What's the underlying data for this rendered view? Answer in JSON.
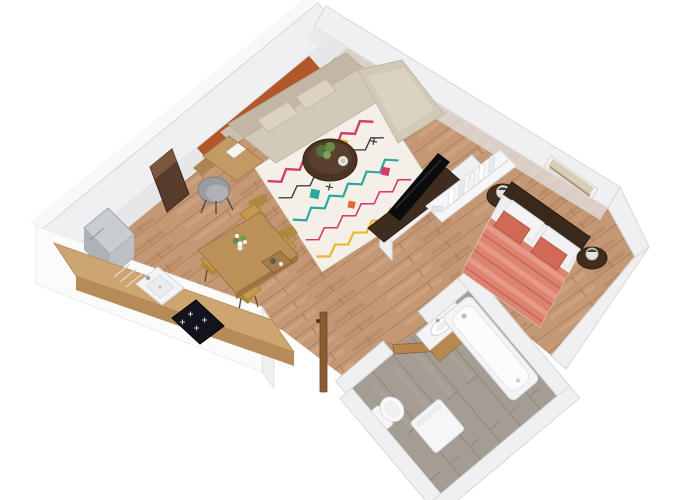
{
  "scene": {
    "kind": "3d-floorplan-cutaway-render",
    "background": "#ffffff",
    "view": "isometric top-down, rotated ~40 degrees"
  },
  "apartment": {
    "rooms": [
      {
        "name": "living-room",
        "items": [
          "sectional-sofa",
          "area-rug",
          "coffee-table",
          "desk",
          "desk-chair",
          "tall-cabinet",
          "accent-wall"
        ]
      },
      {
        "name": "dining-area",
        "items": [
          "dining-table",
          "dining-chair x4",
          "flower-vase",
          "serving-tray"
        ]
      },
      {
        "name": "kitchen",
        "items": [
          "refrigerator",
          "counter",
          "sink",
          "cooktop"
        ]
      },
      {
        "name": "bedroom",
        "items": [
          "double-bed",
          "headboard",
          "pillows",
          "nightstand x2",
          "table-lamp x2",
          "wall-art",
          "open-closet",
          "tv",
          "tv-stand",
          "partition-wall"
        ]
      },
      {
        "name": "bathroom",
        "items": [
          "bathtub",
          "vanity-sink",
          "toilet",
          "washing-machine",
          "bathroom-door"
        ]
      },
      {
        "name": "entry",
        "items": [
          "entry-door"
        ]
      }
    ]
  },
  "palette": {
    "background": "#ffffff",
    "wall_top": "#f0f0f2",
    "wall_halo": "#f8f8f9",
    "wall_face": "#e7e7ea",
    "wall_edge": "#d7d7db",
    "wall_cap": "#efeff1",
    "accent_wall": "#b25727",
    "floor_wood": "#c49875",
    "floor_wood_line": "#a87a55",
    "floor_wood_light": "#d8b08a",
    "floor_wood_dark": "#a9764a",
    "bath_floor": "#a39d94",
    "bath_floor_line": "#8d877e",
    "sofa": "#d3c9b8",
    "sofa_dark": "#c2b7a5",
    "sofa_pillow": "#dbd2c2",
    "rug_bg": "#f4efe7",
    "rug_pink": "#d63a6e",
    "rug_teal": "#2ba8a0",
    "rug_yellow": "#e8b72a",
    "rug_black": "#3a3a3a",
    "rug_orange": "#e06a3a",
    "coffee_table": "#4b3424",
    "dining_table": "#bb9059",
    "chair_mustard": "#c59a4f",
    "chair_mustard_dark": "#b0883f",
    "desk_wood": "#c29a66",
    "desk_chair": "#9a9ba0",
    "cabinet_dark": "#573b2b",
    "fridge_top": "#c9ccd0",
    "fridge_side": "#aeb2b7",
    "counter": "#cda571",
    "counter_front": "#b58b58",
    "fixture_white": "#f4f4f6",
    "cooktop": "#14141c",
    "tv_black": "#0b0b0e",
    "tv_stand": "#3e2d1f",
    "closet_white": "#f6f6f8",
    "bed_frame": "#39291c",
    "sheet_white": "#efefef",
    "duvet": "#dd8471",
    "duvet_dark": "#c96553",
    "duvet_light": "#e89a88",
    "pillow_white": "#f4f4f6",
    "pillow_coral": "#d06a56",
    "nightstand": "#3f2e1e",
    "art_frame": "#f4f2ee",
    "art_canvas": "#d8cdb5",
    "vanity_wood": "#b8894f",
    "door_wood": "#b5854b",
    "entry_door": "#8a5a32"
  }
}
